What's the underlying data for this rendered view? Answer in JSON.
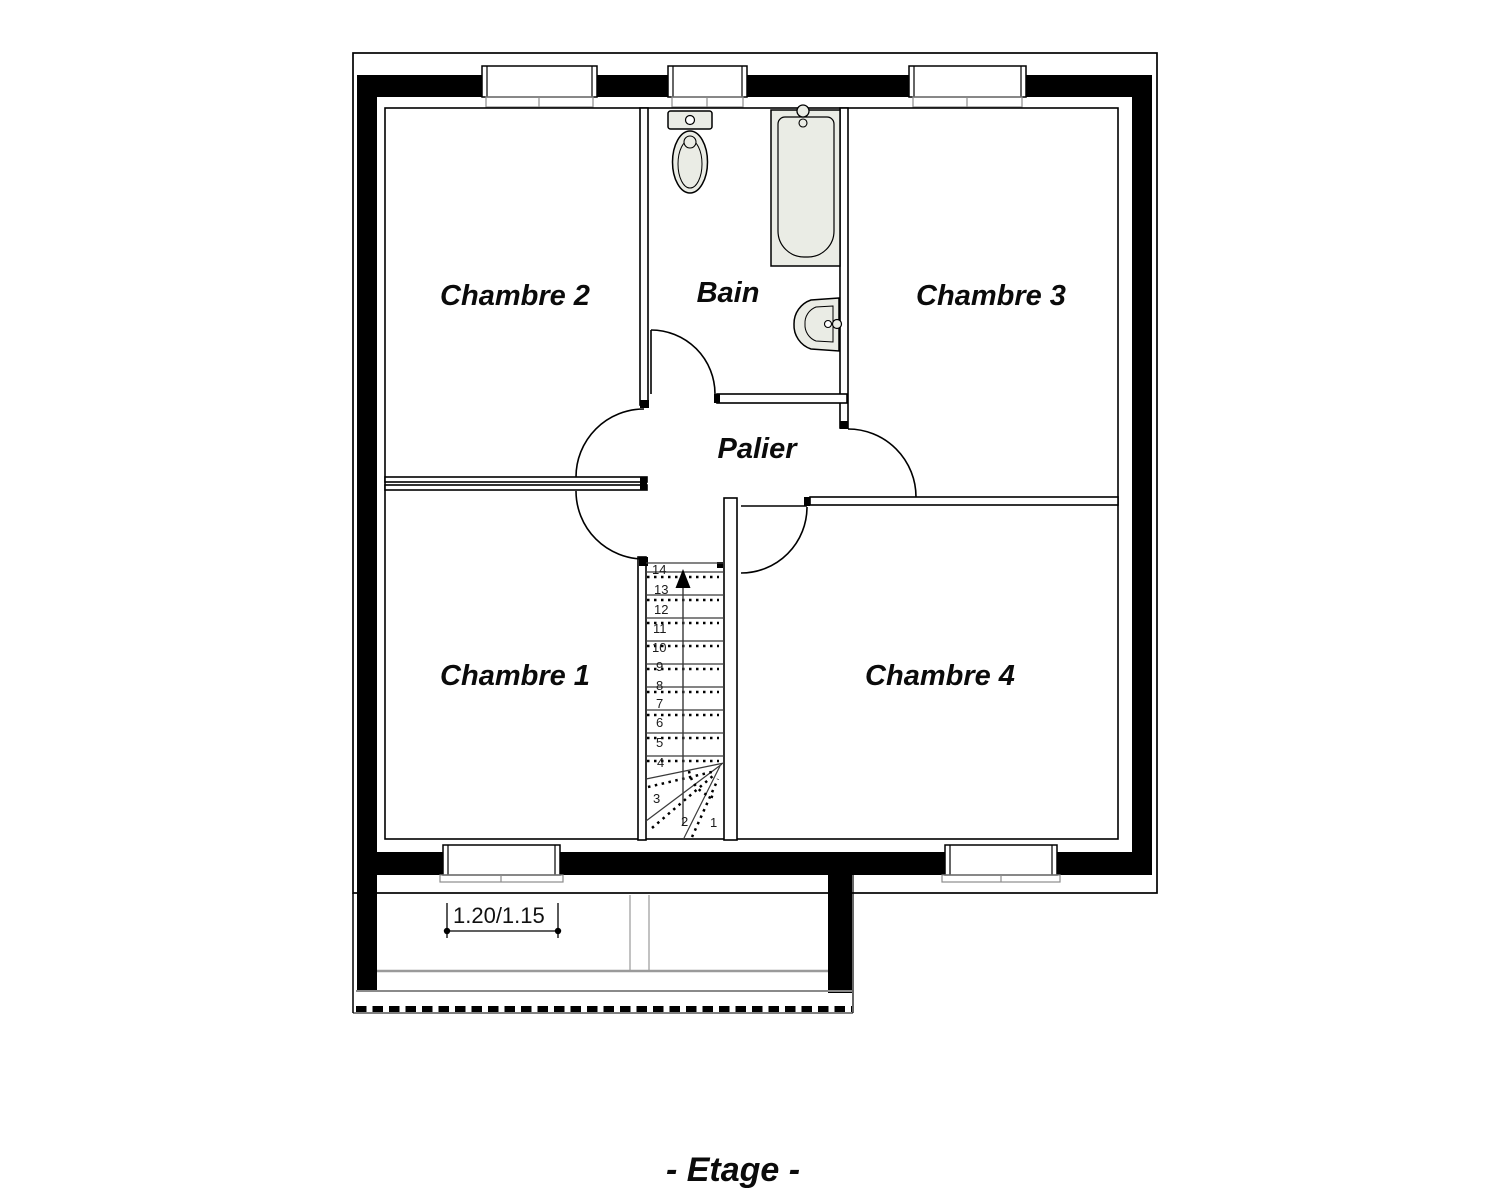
{
  "title": "- Etage -",
  "rooms": {
    "chambre1": "Chambre 1",
    "chambre2": "Chambre 2",
    "chambre3": "Chambre 3",
    "chambre4": "Chambre 4",
    "bain": "Bain",
    "palier": "Palier"
  },
  "stairs": {
    "steps": [
      "1",
      "2",
      "3",
      "4",
      "5",
      "6",
      "7",
      "8",
      "9",
      "10",
      "11",
      "12",
      "13",
      "14"
    ],
    "direction_icon": "up-arrow"
  },
  "dimensions": {
    "balcony_width": "1.20/1.15"
  },
  "colors": {
    "wall": "#000000",
    "fixture_fill": "#eaece5",
    "gray_line": "#9a9a9a"
  }
}
